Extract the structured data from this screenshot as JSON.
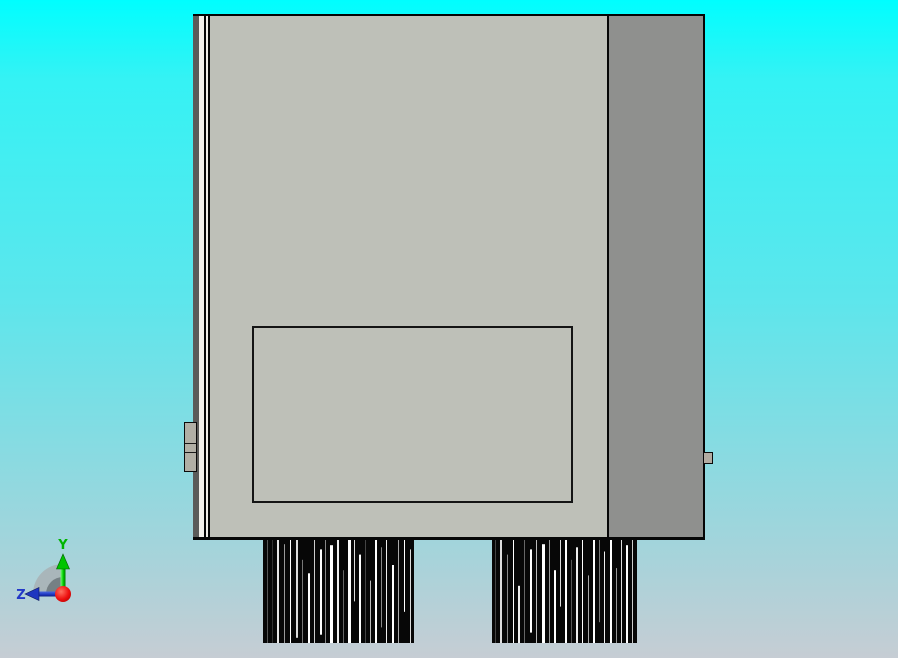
{
  "app": {
    "view": "cad-3d-viewport",
    "projection": "orthographic-rear-view"
  },
  "background": {
    "top_color": "#00feff",
    "bottom_color": "#c6cdd4"
  },
  "model": {
    "front_face_color": "#bec0b8",
    "side_face_color": "#8f908e",
    "edge_dark_color": "#5b5b59",
    "edge_light_color": "#f1efe9",
    "outline_color": "#050505",
    "tab_color": "#b1afa5"
  },
  "pin_arrays": [
    {
      "name": "pin-array-left",
      "width": 151,
      "height": 104,
      "base_color": "#070707",
      "streaks": [
        [
          4,
          1,
          0,
          1,
          "#555555"
        ],
        [
          9,
          1,
          0,
          1,
          "#333333"
        ],
        [
          14,
          2,
          0,
          1,
          "#e8e8e8"
        ],
        [
          21,
          1,
          0.05,
          1,
          "#999999"
        ],
        [
          27,
          1,
          0,
          1,
          "#ffffff"
        ],
        [
          33,
          2,
          0,
          0.95,
          "#dddddd"
        ],
        [
          39,
          1,
          0.2,
          1,
          "#777777"
        ],
        [
          45,
          2,
          0.33,
          1,
          "#ffffff"
        ],
        [
          51,
          1,
          0,
          1,
          "#cccccc"
        ],
        [
          57,
          2,
          0.1,
          0.92,
          "#ffffff"
        ],
        [
          62,
          1,
          0,
          1,
          "#888888"
        ],
        [
          67,
          3,
          0.06,
          1,
          "#ffffff"
        ],
        [
          74,
          2,
          0,
          1,
          "#eeeeee"
        ],
        [
          80,
          1,
          0.3,
          1,
          "#666666"
        ],
        [
          85,
          3,
          0,
          1,
          "#ffffff"
        ],
        [
          91,
          1,
          0,
          0.6,
          "#dddddd"
        ],
        [
          96,
          2,
          0.15,
          1,
          "#ffffff"
        ],
        [
          102,
          1,
          0,
          1,
          "#444444"
        ],
        [
          107,
          1,
          0.4,
          1,
          "#bbbbbb"
        ],
        [
          112,
          2,
          0,
          1,
          "#ffffff"
        ],
        [
          118,
          1,
          0.08,
          0.85,
          "#888888"
        ],
        [
          123,
          1,
          0,
          1,
          "#eeeeee"
        ],
        [
          129,
          2,
          0.25,
          1,
          "#ffffff"
        ],
        [
          135,
          1,
          0,
          1,
          "#aaaaaa"
        ],
        [
          141,
          1,
          0,
          0.7,
          "#ffffff"
        ],
        [
          147,
          1,
          0.1,
          1,
          "#dddddd"
        ]
      ]
    },
    {
      "name": "pin-array-right",
      "width": 145,
      "height": 104,
      "base_color": "#070707",
      "streaks": [
        [
          3,
          1,
          0,
          1,
          "#444444"
        ],
        [
          8,
          2,
          0,
          1,
          "#dddddd"
        ],
        [
          15,
          1,
          0.15,
          1,
          "#888888"
        ],
        [
          21,
          1,
          0,
          1,
          "#ffffff"
        ],
        [
          26,
          2,
          0.45,
          1,
          "#eeeeee"
        ],
        [
          32,
          1,
          0,
          1,
          "#666666"
        ],
        [
          38,
          2,
          0.1,
          0.9,
          "#ffffff"
        ],
        [
          44,
          1,
          0,
          1,
          "#bbbbbb"
        ],
        [
          50,
          3,
          0.05,
          1,
          "#ffffff"
        ],
        [
          57,
          1,
          0,
          1,
          "#999999"
        ],
        [
          62,
          2,
          0.3,
          1,
          "#ffffff"
        ],
        [
          68,
          1,
          0,
          0.65,
          "#dddddd"
        ],
        [
          73,
          2,
          0,
          1,
          "#ffffff"
        ],
        [
          79,
          1,
          0.2,
          1,
          "#555555"
        ],
        [
          84,
          2,
          0.08,
          1,
          "#eeeeee"
        ],
        [
          90,
          1,
          0,
          1,
          "#ffffff"
        ],
        [
          96,
          1,
          0.35,
          1,
          "#aaaaaa"
        ],
        [
          101,
          2,
          0,
          1,
          "#ffffff"
        ],
        [
          107,
          1,
          0,
          0.8,
          "#777777"
        ],
        [
          112,
          1,
          0.12,
          1,
          "#eeeeee"
        ],
        [
          118,
          2,
          0,
          1,
          "#ffffff"
        ],
        [
          124,
          1,
          0.28,
          1,
          "#999999"
        ],
        [
          129,
          1,
          0,
          1,
          "#dddddd"
        ],
        [
          134,
          2,
          0.06,
          1,
          "#ffffff"
        ],
        [
          140,
          1,
          0,
          1,
          "#cccccc"
        ]
      ]
    }
  ],
  "triad": {
    "y_label": "Y",
    "z_label": "Z",
    "y_color": "#00b400",
    "z_color": "#2238c8",
    "origin_color": "#e01010",
    "fan_outer_color": "#a8b1b4",
    "fan_inner_color": "#6f7a7e"
  }
}
